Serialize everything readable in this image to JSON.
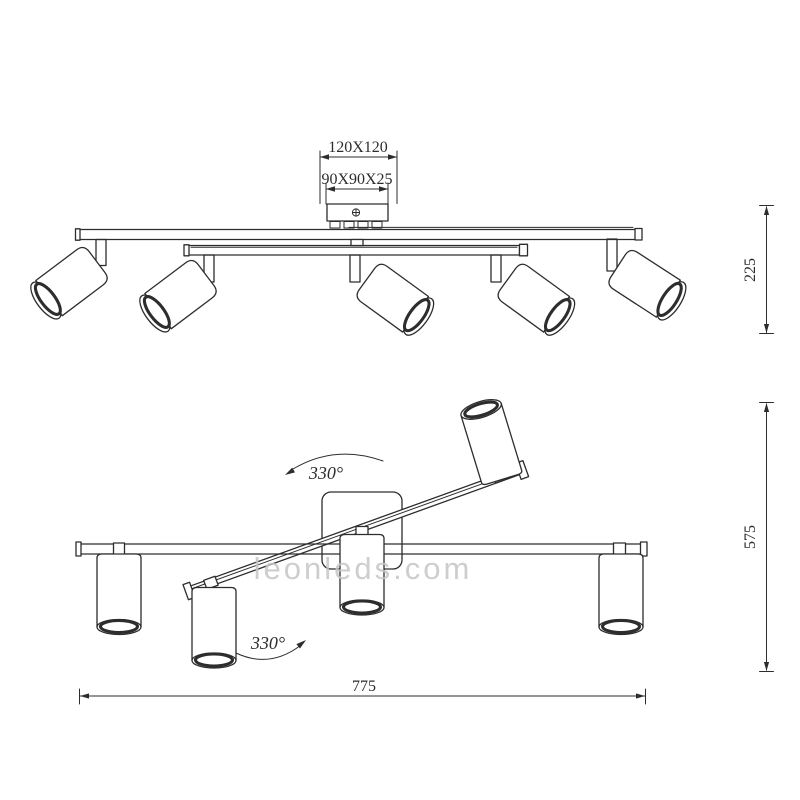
{
  "colors": {
    "line": "#2d2d2d",
    "watermark": "#c6c6c6",
    "background": "#ffffff"
  },
  "watermark": {
    "text": "leonleds.com"
  },
  "top_view": {
    "canopy_outer_dim": "120X120",
    "canopy_inner_dim": "90X90X25",
    "height_dim": "225"
  },
  "bottom_view": {
    "height_dim": "575",
    "width_dim": "775",
    "upper_rotation": "330°",
    "lower_rotation": "330°"
  }
}
